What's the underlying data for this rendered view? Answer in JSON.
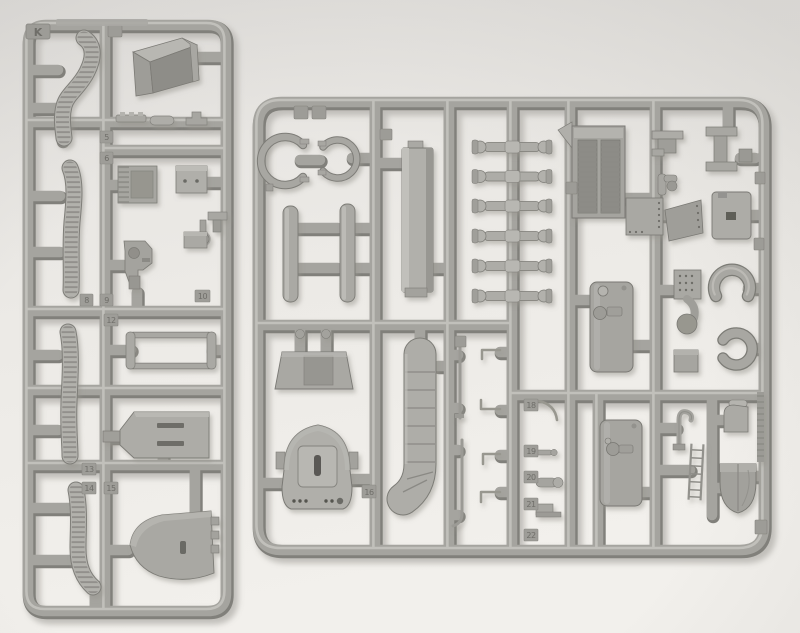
{
  "scene": {
    "type": "photograph",
    "subject": "Two light-grey injection-moulded plastic model kit sprues (parts trees) lying on a pale white surface",
    "orientation": "tall narrow sprue on the left, large square sprue on the right"
  },
  "colors": {
    "background": "#ece9e5",
    "plastic_base": "#a5a49f",
    "plastic_light": "#c4c3be",
    "plastic_dark": "#81807b",
    "cast_shadow": "#c2c0bc",
    "recess_dark": "#5f5e59"
  },
  "left_sprue": {
    "gate_letter": "K",
    "tab_numbers": [
      "5",
      "6",
      "8",
      "9",
      "10",
      "12",
      "13",
      "14",
      "15"
    ],
    "parts": [
      "curved track-link run (top)",
      "straight track-link run (upper)",
      "straight track-link run (lower)",
      "curved track-link run (bottom)",
      "angled stowage bin",
      "small fittings strip",
      "radiator grille plate",
      "detail box with two bolts",
      "gun mount bracket",
      "towing ring",
      "small bracket",
      "small detail box",
      "open rectangular frame",
      "slotted trapezoid plate",
      "rounded bow plate with slot"
    ]
  },
  "right_sprue": {
    "tab_numbers": [
      "16",
      "18",
      "19",
      "20",
      "21",
      "22"
    ],
    "parts": [
      "large curved grab handle",
      "small curved grab handle",
      "suspension bar (left)",
      "suspension bar (right)",
      "long fender plank",
      "six torsion-bar spindles",
      "V-engine block with ribbed banks",
      "foot bracket",
      "pipe elbow",
      "perforated hull plates",
      "I-beam bracket",
      "plate with rectangular hole",
      "U-shaped tow shackle (upper)",
      "U-shaped tow shackle (lower)",
      "fuel tank with filler cap (upper)",
      "fuel tank with filler cap (lower)",
      "mantlet trapezoid plate",
      "rounded mantlet dome with slotted block",
      "segmented curved fender",
      "thin rod parts",
      "exhaust pipe with perforated shield",
      "tow hook",
      "small ladder",
      "periscope wedge",
      "dome cover",
      "serrated moulding strip"
    ]
  }
}
